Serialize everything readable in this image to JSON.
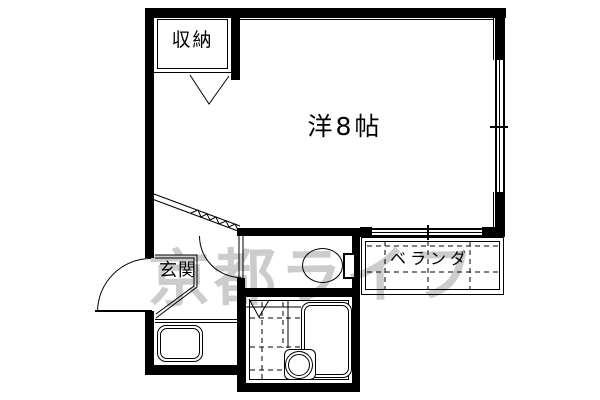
{
  "floorplan": {
    "rooms": {
      "closet": {
        "label": "収納"
      },
      "main_room": {
        "label": "洋8帖"
      },
      "entrance": {
        "label": "玄関"
      },
      "balcony": {
        "label": "ベランダ"
      }
    },
    "watermark": {
      "text": "京都ライフ"
    },
    "colors": {
      "line": "#000000",
      "background": "#ffffff",
      "watermark": "#999999"
    }
  }
}
